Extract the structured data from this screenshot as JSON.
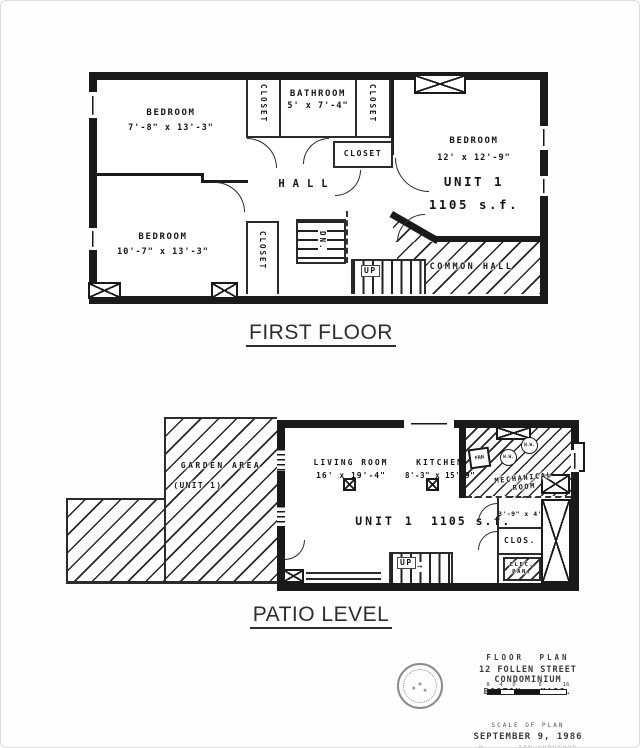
{
  "headings": {
    "first_floor": "FIRST FLOOR",
    "patio_level": "PATIO LEVEL"
  },
  "first_floor": {
    "bedroom_tl": {
      "name": "BEDROOM",
      "dims": "7'-8\" x 13'-3\""
    },
    "bedroom_bl": {
      "name": "BEDROOM",
      "dims": "10'-7\" x 13'-3\""
    },
    "bedroom_r": {
      "name": "BEDROOM",
      "dims": "12' x 12'-9\"",
      "unit": "UNIT 1",
      "area": "1105 s.f."
    },
    "bathroom": {
      "name": "BATHROOM",
      "dims": "5' x 7'-4\""
    },
    "hall": "HALL",
    "closet": "CLOSET",
    "common_hall": "COMMON HALL",
    "stair_dn": "DN.",
    "stair_up": "UP"
  },
  "patio": {
    "garden": {
      "name": "GARDEN AREA",
      "sub": "(UNIT 1)"
    },
    "living_room": {
      "name": "LIVING ROOM",
      "dims": "16' x 19'-4\""
    },
    "kitchen": {
      "name": "KITCHEN",
      "dims": "8'-3\" x 15'-9\""
    },
    "unit": "UNIT 1",
    "area": "1105 s.f.",
    "mechanical": {
      "line1": "MECHANICAL",
      "line2": "ROOM",
      "furnace": "FRN",
      "hw": "H.W."
    },
    "room_3_9": "3'-9\" x 4'",
    "closet": "CLOS.",
    "elec_line1": "ELEC.",
    "elec_line2": "PAN.",
    "stair_up": "UP"
  },
  "title_block": {
    "line1": "FLOOR PLAN",
    "line2": "12 FOLLEN STREET CONDOMINIUM",
    "line3": "BOSTON , MASS.",
    "scale_ticks": [
      "8",
      "4",
      "0",
      "8",
      "16"
    ],
    "scale_label": "SCALE OF PLAN",
    "date": "SEPTEMBER 9, 1986",
    "surveyor": "P·· ····ION SURVEYOR"
  },
  "colors": {
    "ink": "#1a1a1a",
    "paper": "#ffffff"
  }
}
